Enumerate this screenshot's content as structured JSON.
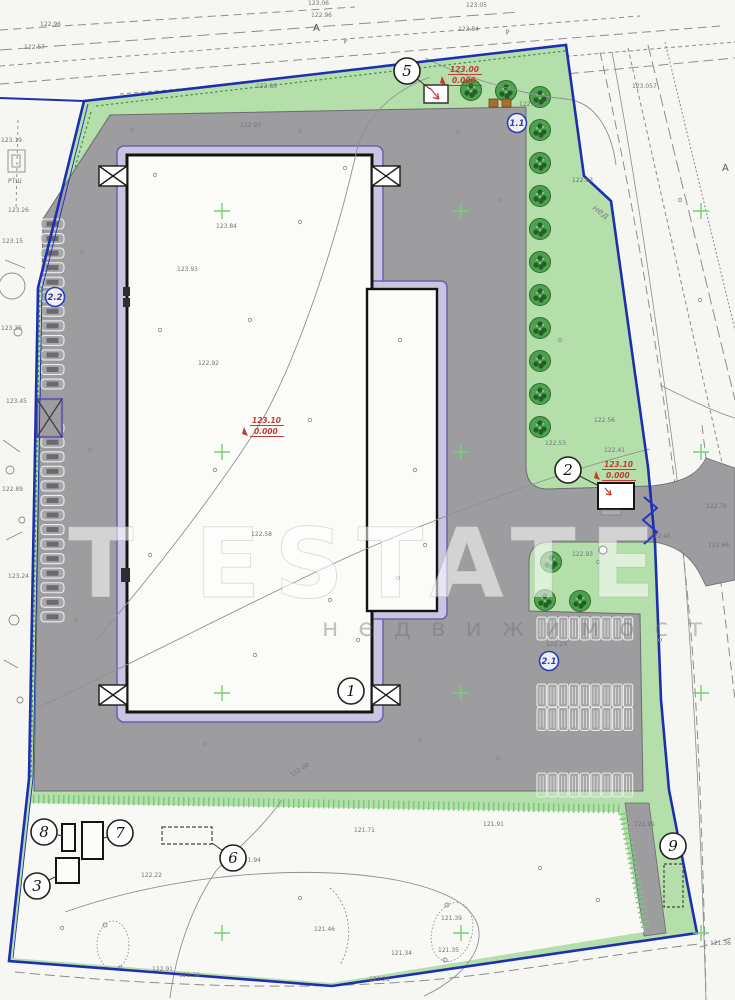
{
  "watermark": {
    "line1": "T ESTATE",
    "line2": "н е д в и ж и м о с т"
  },
  "colors": {
    "boundary_blue": "#1d2fae",
    "green_area": "#b4dfab",
    "asphalt_gray": "#9d9da0",
    "building_white": "#fbfbf8",
    "blind_area_purple": "#c8c6df",
    "purple_outline": "#6b60b0",
    "tree_green": "#4fa04f",
    "hatch_green": "#79c979",
    "grid_cross_green": "#74d074",
    "red_annotation": "#c23b34",
    "label_gray": "#74747a"
  },
  "plan": {
    "callouts": [
      {
        "n": "5",
        "cx": 407,
        "cy": 71,
        "tx": 430,
        "ty": 89
      },
      {
        "n": "1",
        "cx": 351,
        "cy": 691
      },
      {
        "n": "2",
        "cx": 568,
        "cy": 470,
        "tx": 599,
        "ty": 486
      },
      {
        "n": "6",
        "cx": 233,
        "cy": 858,
        "tx": 212,
        "ty": 843
      },
      {
        "n": "7",
        "cx": 120,
        "cy": 833,
        "tx": 104,
        "ty": 838
      },
      {
        "n": "8",
        "cx": 44,
        "cy": 832,
        "tx": 63,
        "ty": 836
      },
      {
        "n": "3",
        "cx": 37,
        "cy": 886,
        "tx": 57,
        "ty": 876
      },
      {
        "n": "9",
        "cx": 673,
        "cy": 846
      }
    ],
    "blue_callouts": [
      {
        "n": "1.1",
        "cx": 517,
        "cy": 123
      },
      {
        "n": "2.2",
        "cx": 55,
        "cy": 297
      },
      {
        "n": "2.1",
        "cx": 549,
        "cy": 661
      }
    ],
    "red_elevations": [
      {
        "x": 450,
        "y": 72,
        "top": "123.00",
        "bot": "0.000"
      },
      {
        "x": 252,
        "y": 423,
        "top": "123.10",
        "bot": "0.000"
      },
      {
        "x": 604,
        "y": 467,
        "top": "123.10",
        "bot": "0.000"
      }
    ],
    "axis_letters": [
      {
        "t": "А",
        "x": 313,
        "y": 31
      },
      {
        "t": "А",
        "x": 722,
        "y": 171
      }
    ],
    "pipe_letters": [
      {
        "t": "Р",
        "x": 344,
        "y": 44,
        "r": -10
      },
      {
        "t": "Р",
        "x": 506,
        "y": 35,
        "r": -10
      }
    ],
    "road_label": {
      "t": "нед",
      "x": 592,
      "y": 209,
      "r": 36
    },
    "spot_labels": [
      {
        "t": "123.06",
        "x": 308,
        "y": 5
      },
      {
        "t": "123.05",
        "x": 466,
        "y": 7
      },
      {
        "t": "122.96",
        "x": 311,
        "y": 17
      },
      {
        "t": "123.84",
        "x": 458,
        "y": 31
      },
      {
        "t": "122.96",
        "x": 40,
        "y": 26
      },
      {
        "t": "122.57",
        "x": 24,
        "y": 49
      },
      {
        "t": "122.86",
        "x": 256,
        "y": 88
      },
      {
        "t": "122.93",
        "x": 240,
        "y": 127
      },
      {
        "t": "123.19",
        "x": 1,
        "y": 142
      },
      {
        "t": "РТШ",
        "x": 8,
        "y": 183
      },
      {
        "t": "123.26",
        "x": 8,
        "y": 212
      },
      {
        "t": "123.15",
        "x": 2,
        "y": 243
      },
      {
        "t": "123.35",
        "x": 1,
        "y": 330
      },
      {
        "t": "123.45",
        "x": 6,
        "y": 403
      },
      {
        "t": "122.89",
        "x": 2,
        "y": 491
      },
      {
        "t": "123.24",
        "x": 8,
        "y": 578
      },
      {
        "t": "123.057",
        "x": 632,
        "y": 88
      },
      {
        "t": "122.63",
        "x": 572,
        "y": 182
      },
      {
        "t": "122.76",
        "x": 706,
        "y": 508
      },
      {
        "t": "122.66",
        "x": 708,
        "y": 547
      },
      {
        "t": "122.45",
        "x": 650,
        "y": 538
      },
      {
        "t": "122.56",
        "x": 594,
        "y": 422
      },
      {
        "t": "122.53",
        "x": 545,
        "y": 445
      },
      {
        "t": "122.41",
        "x": 604,
        "y": 452
      },
      {
        "t": "122.93",
        "x": 572,
        "y": 556
      },
      {
        "t": "122.23",
        "x": 546,
        "y": 646
      },
      {
        "t": "123.84",
        "x": 216,
        "y": 228
      },
      {
        "t": "123.93",
        "x": 177,
        "y": 271
      },
      {
        "t": "122.92",
        "x": 198,
        "y": 365
      },
      {
        "t": "122.58",
        "x": 251,
        "y": 536
      },
      {
        "t": "122.00",
        "x": 292,
        "y": 777,
        "r": -33
      },
      {
        "t": "121.71",
        "x": 354,
        "y": 832
      },
      {
        "t": "121.91",
        "x": 483,
        "y": 826
      },
      {
        "t": "121.94",
        "x": 240,
        "y": 862
      },
      {
        "t": "122.22",
        "x": 141,
        "y": 877
      },
      {
        "t": "121.39",
        "x": 441,
        "y": 920
      },
      {
        "t": "121.46",
        "x": 314,
        "y": 931
      },
      {
        "t": "121.34",
        "x": 391,
        "y": 955
      },
      {
        "t": "121.34",
        "x": 179,
        "y": 977
      },
      {
        "t": "121.21",
        "x": 369,
        "y": 981
      },
      {
        "t": "122.91",
        "x": 152,
        "y": 971
      },
      {
        "t": "121.35",
        "x": 438,
        "y": 952
      },
      {
        "t": "122.64",
        "x": 519,
        "y": 106
      },
      {
        "t": "121.36",
        "x": 710,
        "y": 945
      },
      {
        "t": "121.91",
        "x": 634,
        "y": 826
      }
    ],
    "trees": [
      {
        "x": 471,
        "y": 90
      },
      {
        "x": 506,
        "y": 91
      },
      {
        "x": 540,
        "y": 97
      },
      {
        "x": 540,
        "y": 130
      },
      {
        "x": 540,
        "y": 163
      },
      {
        "x": 540,
        "y": 196
      },
      {
        "x": 540,
        "y": 229
      },
      {
        "x": 540,
        "y": 262
      },
      {
        "x": 540,
        "y": 295
      },
      {
        "x": 540,
        "y": 328
      },
      {
        "x": 540,
        "y": 361
      },
      {
        "x": 540,
        "y": 394
      },
      {
        "x": 540,
        "y": 427
      },
      {
        "x": 551,
        "y": 562
      },
      {
        "x": 545,
        "y": 600
      },
      {
        "x": 580,
        "y": 601
      }
    ],
    "grid_crosses": {
      "xs": [
        222,
        461,
        701
      ],
      "ys": [
        211,
        452,
        693,
        933
      ]
    },
    "parking": {
      "right_rows": [
        {
          "x": 537,
          "y": 617,
          "n": 9,
          "w": 10.8,
          "h": 23
        },
        {
          "x": 537,
          "y": 684,
          "n": 9,
          "w": 10.8,
          "h": 23
        },
        {
          "x": 537,
          "y": 707.5,
          "n": 9,
          "w": 10.8,
          "h": 23
        },
        {
          "x": 537,
          "y": 773,
          "n": 9,
          "w": 10.8,
          "h": 24
        }
      ],
      "left_column": {
        "x": 41,
        "y": 219,
        "n": 28,
        "w": 23,
        "h": 10,
        "pitch": 14.55,
        "skip": [
          12,
          13
        ]
      }
    }
  }
}
